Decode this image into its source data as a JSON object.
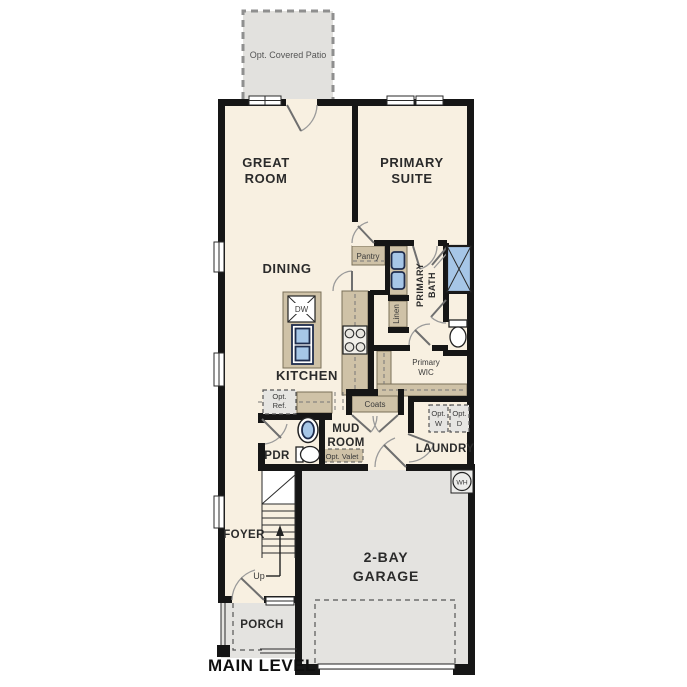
{
  "meta": {
    "type": "residential-floor-plan",
    "level": "MAIN LEVEL"
  },
  "colors": {
    "floor": "#f8f0e1",
    "concrete": "#e4e3e0",
    "patio": "#e2e1de",
    "millwork": "#cfc2a7",
    "fixture": "#a6c6e7",
    "wall": "#161616",
    "optbox": "#e6e5e2"
  },
  "labels": {
    "patio": "Opt. Covered Patio",
    "great_room": [
      "GREAT",
      "ROOM"
    ],
    "primary_suite": [
      "PRIMARY",
      "SUITE"
    ],
    "dining": "DINING",
    "kitchen": "KITCHEN",
    "pantry": "Pantry",
    "dishwasher": "DW",
    "primary_bath": [
      "PRIMARY",
      "BATH"
    ],
    "linen": "Linen",
    "primary_wic": [
      "Primary",
      "WIC"
    ],
    "opt_ref": [
      "Opt.",
      "Ref."
    ],
    "coats": "Coats",
    "mud_room": [
      "MUD",
      "ROOM"
    ],
    "opt_valet": "Opt. Valet",
    "pdr": "PDR",
    "laundry": "LAUNDRY",
    "opt_washer": [
      "Opt.",
      "W"
    ],
    "opt_dryer": [
      "Opt.",
      "D"
    ],
    "water_heater": "WH",
    "foyer": "FOYER",
    "up": "Up",
    "garage": [
      "2-BAY",
      "GARAGE"
    ],
    "porch": "PORCH",
    "main_level": "MAIN LEVEL"
  }
}
